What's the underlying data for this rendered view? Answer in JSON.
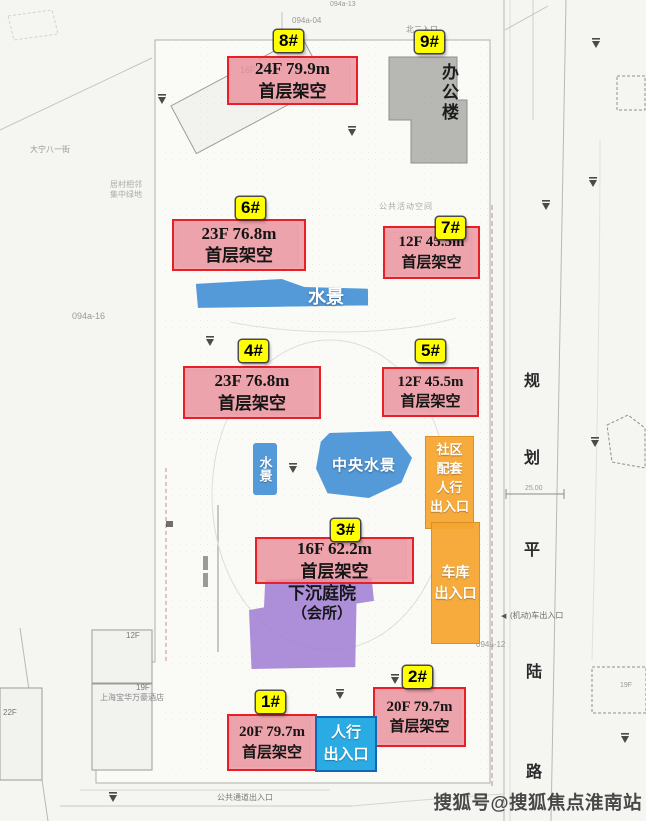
{
  "watermark": "搜狐号@搜狐焦点淮南站",
  "towers": [
    {
      "id": "1#",
      "line1": "20F 79.7m",
      "line2": "首层架空"
    },
    {
      "id": "2#",
      "line1": "20F 79.7m",
      "line2": "首层架空"
    },
    {
      "id": "3#",
      "line1": "16F 62.2m",
      "line2": "首层架空"
    },
    {
      "id": "4#",
      "line1": "23F 76.8m",
      "line2": "首层架空"
    },
    {
      "id": "5#",
      "line1": "12F 45.5m",
      "line2": "首层架空"
    },
    {
      "id": "6#",
      "line1": "23F 76.8m",
      "line2": "首层架空"
    },
    {
      "id": "7#",
      "line1": "12F 45.5m",
      "line2": "首层架空"
    },
    {
      "id": "8#",
      "line1": "24F 79.9m",
      "line2": "首层架空"
    },
    {
      "id": "9#"
    }
  ],
  "features": {
    "office": "办公楼",
    "water_band": "水景",
    "water_small": "水景",
    "central_water": "中央水景",
    "sunken_line1": "下沉庭院",
    "sunken_line2": "（会所）"
  },
  "entrances": {
    "community": [
      "社区",
      "配套",
      "人行",
      "出入口"
    ],
    "garage": [
      "车库",
      "出入口"
    ],
    "pedestrian": [
      "人行",
      "出入口"
    ]
  },
  "road_name": [
    "规",
    "划",
    "平",
    "陆",
    "路"
  ],
  "plan_labels": {
    "top_code1": "094a-13",
    "top_code2": "094a-04",
    "top_entrance": "北二入口",
    "public_space": "公共活动空间",
    "mid_code": "094a-16",
    "right_code": "094a-12",
    "vehicle_exit": "(机动)车出入口",
    "public_passage": "公共通道出入口",
    "hotel": "上海宝华万豪酒店",
    "street": "大宁八一街",
    "green1": "居村相邻",
    "green2": "集中绿地",
    "f16": "16F",
    "f12": "12F",
    "f19": "19F",
    "f22": "22F",
    "f19b": "19F",
    "dim": "25.00"
  },
  "colors": {
    "badge_yellow": "#ffff00",
    "box_border_red": "#e81f26",
    "box_fill_pink": "#ee949d",
    "water_blue": "#549ad8",
    "entrance_cyan": "#2aabe4",
    "entrance_cyan_border": "#1566b0",
    "entrance_orange": "#f6a732",
    "courtyard_purple": "#a482d4",
    "office_gray": "#b7b7b4"
  }
}
